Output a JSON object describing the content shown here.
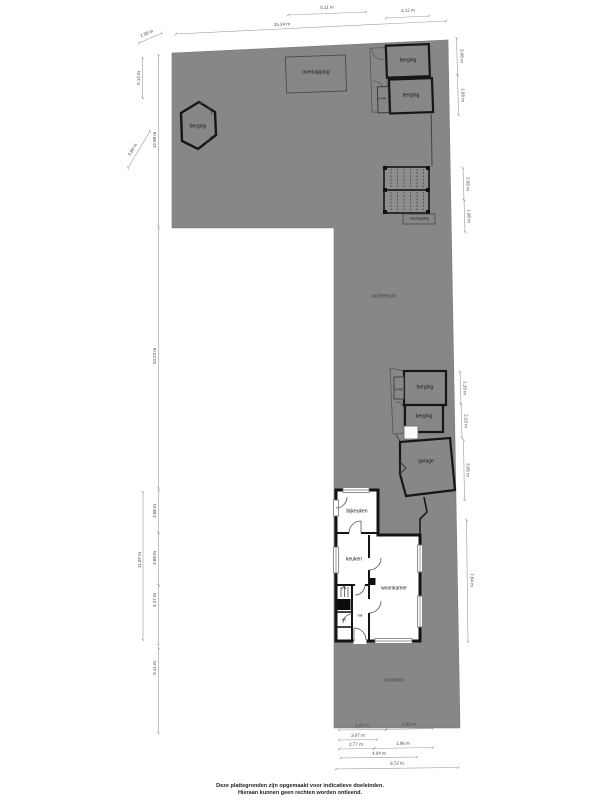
{
  "plan": {
    "areas": {
      "backyard": "achtertuin",
      "frontyard": "voortuin"
    },
    "rooms": {
      "overkapping_top": "overkapping",
      "berging_top_1": "berging",
      "berging_top_2": "berging",
      "emk_top": "e-mk",
      "berging_hex": "berging",
      "overkapping_pergola": "overkapping",
      "berging_mid_1": "berging",
      "berging_mid_2": "berging",
      "emk_mid": "e-mk",
      "garage": "garage",
      "bijkeuken": "bijkeuken",
      "keuken": "keuken",
      "woonkamer": "woonkamer",
      "hal": "hal",
      "wc": "wc"
    }
  },
  "dimensions": {
    "top": [
      "5.11 m",
      "15.24 m",
      "3.12 m"
    ],
    "left": [
      "1.06 m",
      "5.12 m",
      "12.88 m",
      "2.88 m",
      "23.23 m",
      "11.07 m",
      "3.08 m",
      "3.68 m",
      "4.27 m",
      "6.11 m"
    ],
    "right": [
      "3.06 m",
      "1.68 m",
      "2.65 m",
      "1.98 m",
      "1.20 m",
      "2.23 m",
      "3.05 m",
      "7.84 m"
    ],
    "bottom": [
      "3.20 m",
      "3.65 m",
      "3.07 m",
      "2.77 m",
      "1.96 m",
      "4.04 m",
      "9.72 m"
    ]
  },
  "footer": {
    "line1": "Deze plattegronden zijn opgemaakt voor indicatieve doeleinden.",
    "line2": "Hieraan kunnen geen rechten worden ontleend."
  },
  "colors": {
    "plot": "#878787",
    "wall": "#141414",
    "dimline": "#999999"
  }
}
